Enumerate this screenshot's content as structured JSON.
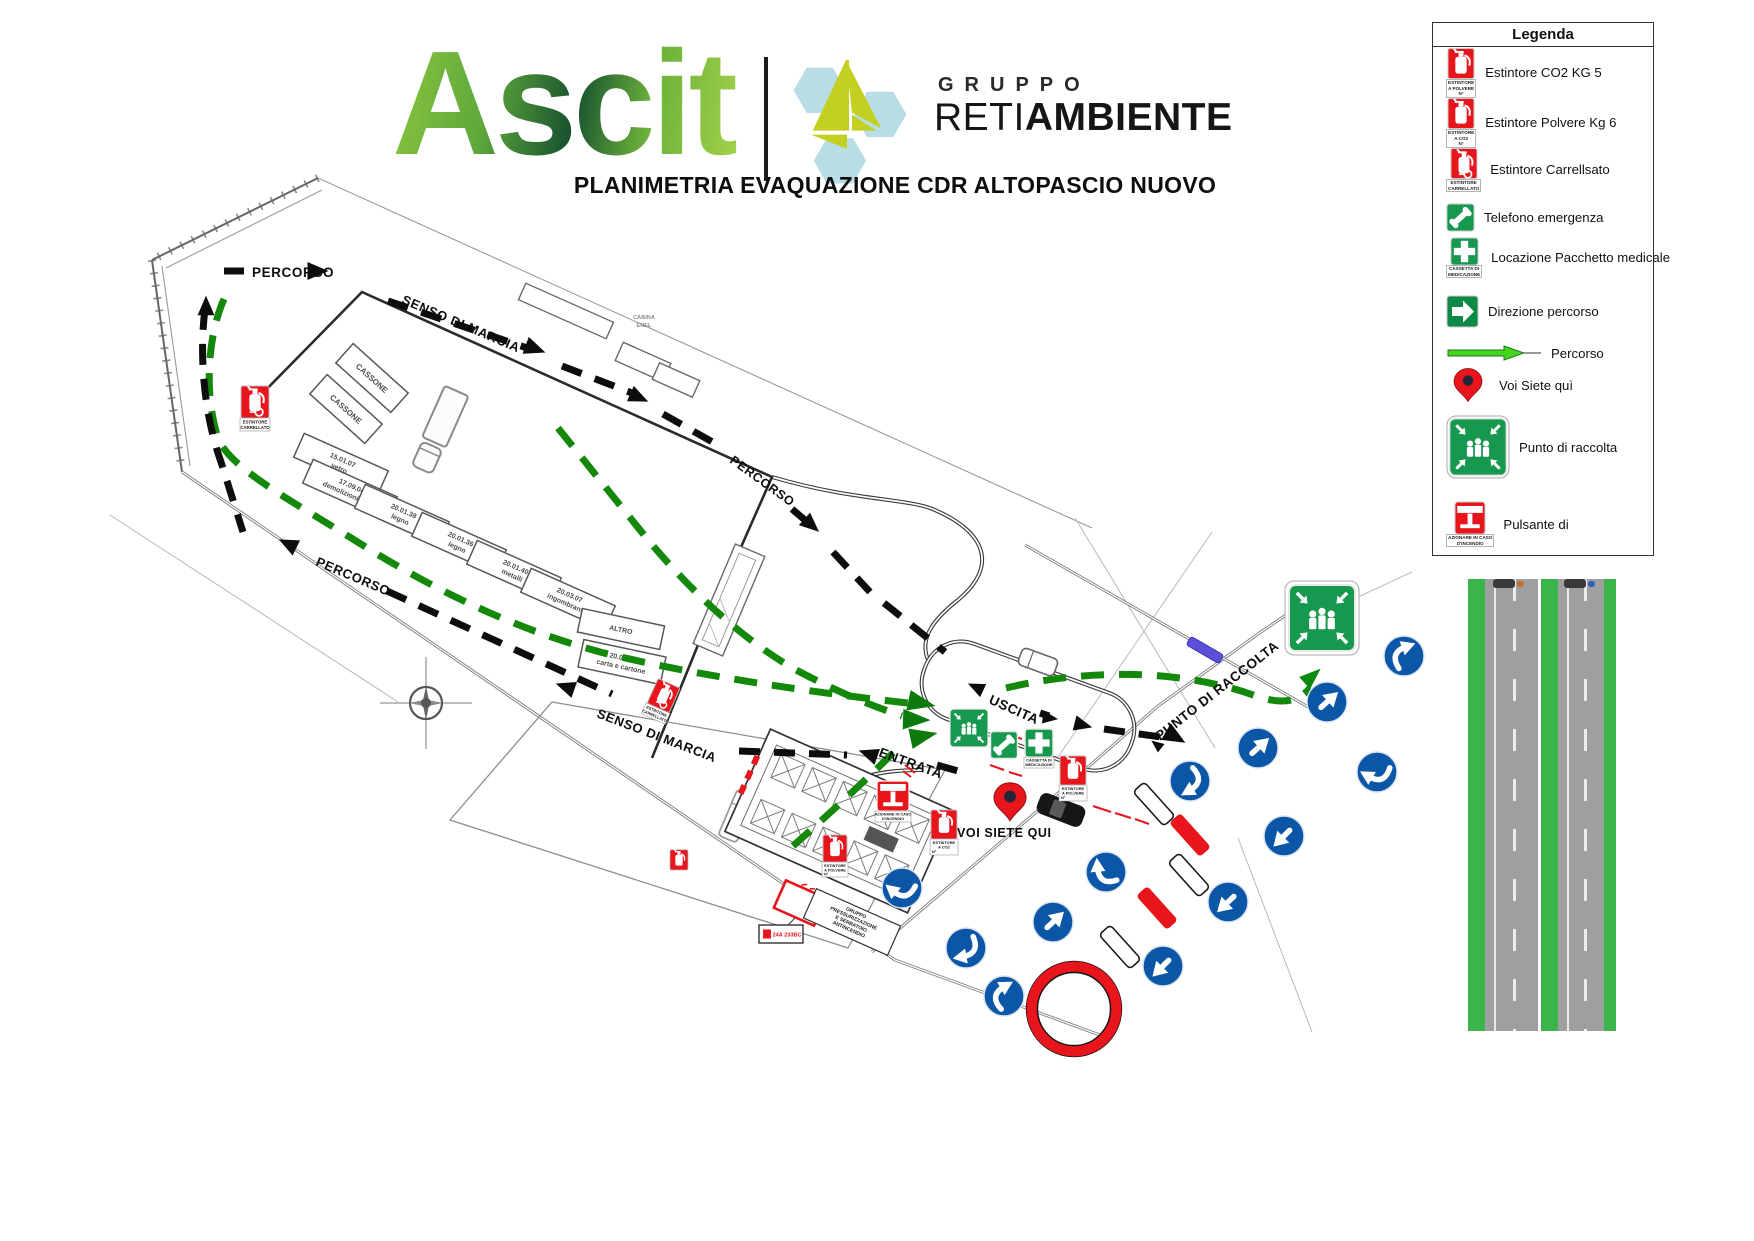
{
  "header": {
    "logo_text": "Ascit",
    "group_label": "GRUPPO",
    "brand_light": "RETI",
    "brand_bold": "AMBIENTE",
    "title": "PLANIMETRIA EVAQUAZIONE CDR ALTOPASCIO NUOVO"
  },
  "legend": {
    "title": "Legenda",
    "items": [
      {
        "icon": "extinguisher-powder-sign",
        "caption": "ESTINTORE\nA POLVERE\nN°",
        "label": "Estintore CO2 KG 5"
      },
      {
        "icon": "extinguisher-co2-sign",
        "caption": "ESTINTORE\nA CO2\nN°",
        "label": "Estintore Polvere Kg 6"
      },
      {
        "icon": "extinguisher-wheeled-sign",
        "caption": "ESTINTORE\nCARRELLATO",
        "label": "Estintore Carrellsato"
      },
      {
        "icon": "emergency-phone-sign",
        "caption": "",
        "label": "Telefono emergenza"
      },
      {
        "icon": "first-aid-kit-sign",
        "caption": "CASSETTA DI\nMEDICAZIONE",
        "label": "Locazione Pacchetto medicale"
      },
      {
        "icon": "route-direction-sign",
        "caption": "",
        "label": "Direzione percorso"
      },
      {
        "icon": "route-arrow",
        "caption": "",
        "label": "Percorso"
      },
      {
        "icon": "you-are-here-pin",
        "caption": "",
        "label": "Voi Siete quì"
      },
      {
        "icon": "assembly-point-sign",
        "caption": "",
        "label": "Punto di raccolta"
      },
      {
        "icon": "alarm-button-sign",
        "caption": "AZIONARE IN CASO\nD'INCENDIO",
        "label": "Pulsante di"
      }
    ]
  },
  "map": {
    "labels": {
      "percorso_top": "PERCORSO",
      "senso_di_marcia_top": "SENSO DI MARCIA",
      "percorso_right": "PERCORSO",
      "percorso_left": "PERCORSO",
      "senso_di_marcia_bottom": "SENSO DI MARCIA",
      "uscita": "USCITA",
      "entrata": "ENTRATA",
      "voi_siete_qui": "VOI SIETE QUI",
      "punto_di_raccolta": "PUNTO DI RACCOLTA",
      "cassone": "CASSONE",
      "cabina_enel": [
        "CABINA",
        "ENEL"
      ]
    },
    "bays": [
      {
        "line1": "15.01.07",
        "line2": "vetro"
      },
      {
        "line1": "17.09.04",
        "line2": "demolizioni edili"
      },
      {
        "line1": "20.01.38",
        "line2": "legno"
      },
      {
        "line1": "20.01.36",
        "line2": "legno"
      },
      {
        "line1": "20.01.40",
        "line2": "metalli"
      },
      {
        "line1": "20.03.07",
        "line2": "ingombranti"
      },
      {
        "line1": "ALTRO",
        "line2": ""
      },
      {
        "line1": "20.01.01",
        "line2": "carta e cartone"
      }
    ],
    "captions": {
      "polvere": [
        "ESTINTORE",
        "A POLVERE",
        "N°"
      ],
      "co2": [
        "ESTINTORE",
        "A CO2",
        "N°"
      ],
      "carrellato": [
        "ESTINTORE",
        "CARRELLATO"
      ],
      "medicazione": [
        "CASSETTA DI",
        "MEDICAZIONE"
      ],
      "azionare": [
        "AZIONARE IN CASO",
        "D'INCENDIO"
      ],
      "tank": [
        "GRUPPO",
        "PRESSURIZZAZIONE",
        "E SERBATOIO",
        "ANTINCENDIO"
      ],
      "class_label": "24A 233BC"
    }
  },
  "colors": {
    "safety_green": "#17984f",
    "signal_red": "#e8151c",
    "direction_blue": "#0b56a7",
    "route_green": "#13880b",
    "road_green": "#3bb54a",
    "asphalt_gray": "#9d9fa0",
    "brand_light_blue": "#b9dde4",
    "brand_lime": "#c3d021",
    "ascit_green_light": "#8cc63e",
    "ascit_green_dark": "#17532f"
  }
}
